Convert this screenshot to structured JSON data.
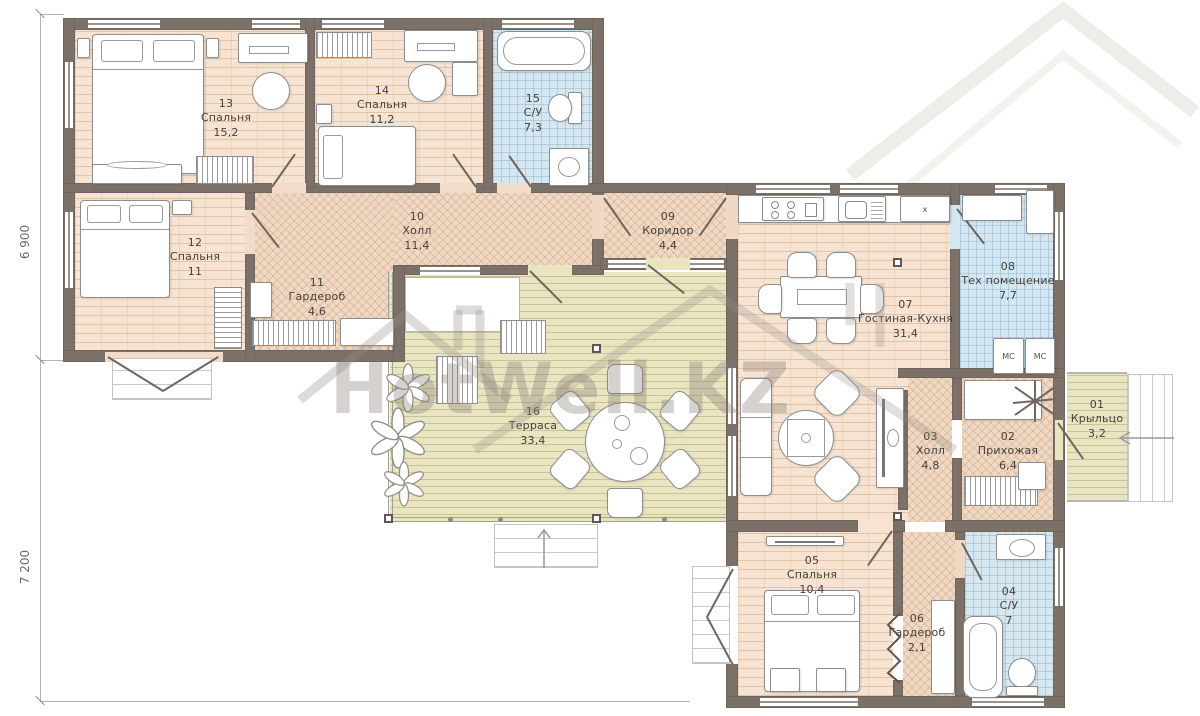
{
  "watermark": {
    "text": "HotWell.KZ"
  },
  "dimensions": {
    "left_top": "6 900",
    "left_bottom": "7 200"
  },
  "labels": {
    "kitchen_appliance": "x",
    "mc_left": "МС",
    "mc_right": "МС"
  },
  "rooms": [
    {
      "number": "13",
      "name": "Спальня",
      "area": "15,2"
    },
    {
      "number": "14",
      "name": "Спальня",
      "area": "11,2"
    },
    {
      "number": "15",
      "name": "С/У",
      "area": "7,3"
    },
    {
      "number": "12",
      "name": "Спальня",
      "area": "11"
    },
    {
      "number": "11",
      "name": "Гардероб",
      "area": "4,6"
    },
    {
      "number": "10",
      "name": "Холл",
      "area": "11,4"
    },
    {
      "number": "09",
      "name": "Коридор",
      "area": "4,4"
    },
    {
      "number": "07",
      "name": "Гостиная-Кухня",
      "area": "31,4"
    },
    {
      "number": "08",
      "name": "Тех помещение",
      "area": "7,7"
    },
    {
      "number": "16",
      "name": "Терраса",
      "area": "33,4"
    },
    {
      "number": "03",
      "name": "Холл",
      "area": "4,8"
    },
    {
      "number": "02",
      "name": "Прихожая",
      "area": "6,4"
    },
    {
      "number": "01",
      "name": "Крыльцо",
      "area": "3,2"
    },
    {
      "number": "05",
      "name": "Спальня",
      "area": "10,4"
    },
    {
      "number": "06",
      "name": "Гардероб",
      "area": "2,1"
    },
    {
      "number": "04",
      "name": "С/У",
      "area": "7"
    }
  ]
}
